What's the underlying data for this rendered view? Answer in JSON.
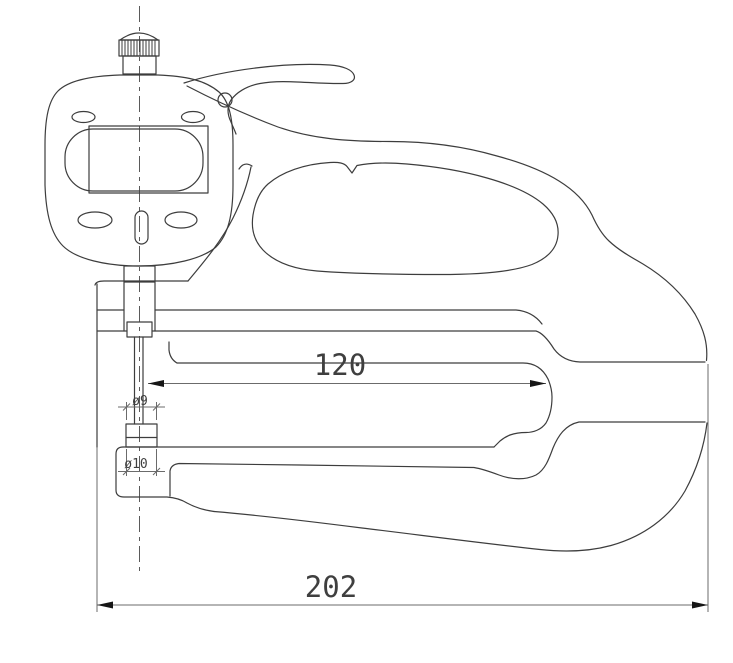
{
  "meta": {
    "type": "engineering-line-drawing",
    "subject": "digital thickness gauge side view"
  },
  "dimensions": {
    "throat_depth": "120",
    "overall_length": "202",
    "contact_diameter": "ø9",
    "anvil_diameter": "ø10"
  },
  "colors": {
    "line": "#3d3d3d",
    "dim_line": "#6b6b6b",
    "centerline": "#5a5a5a",
    "arrow": "#161616",
    "background": "#ffffff"
  }
}
